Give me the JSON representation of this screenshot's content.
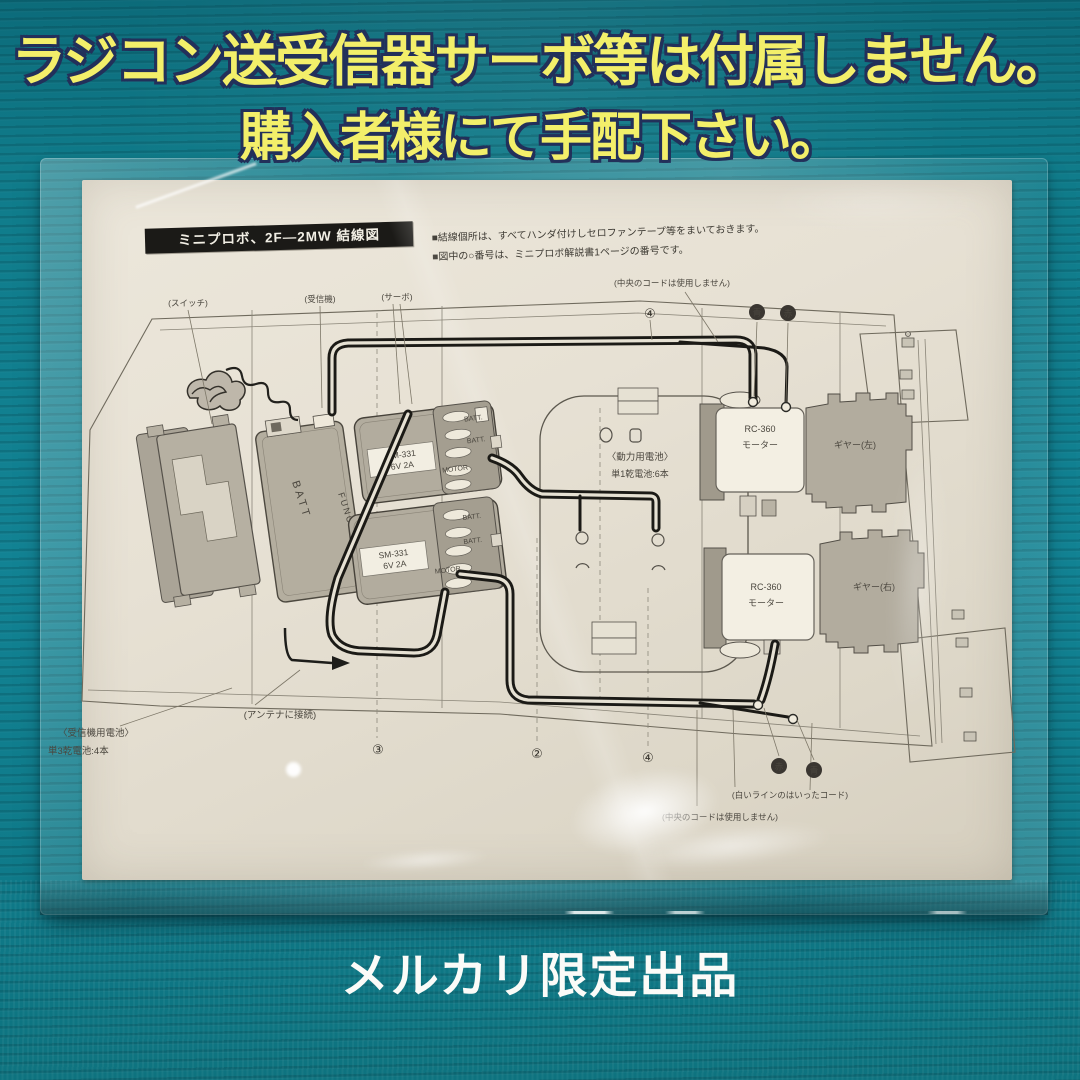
{
  "headline": {
    "line1": "ラジコン送受信器サーボ等は付属しません。",
    "line2": "購入者様にて手配下さい。",
    "text_color": "#f3ef6a",
    "outline_color": "#22305a"
  },
  "caption": {
    "text": "メルカリ限定出品",
    "color": "#fbfbf8"
  },
  "background": {
    "mat_color": "#128394"
  },
  "paper": {
    "title": "ミニプロボ、2F—2MW 結線図",
    "notes": {
      "line1": "■結線個所は、すべてハンダ付けしセロファンテープ等をまいておきます。",
      "line2": "■図中の○番号は、ミニプロボ解説書1ページの番号です。"
    }
  },
  "diagram": {
    "top_labels": {
      "switch": "(スイッチ)",
      "receiver": "(受信機)",
      "servo": "(サーボ)",
      "center_cord": "(中央のコードは使用しません)",
      "num4": "④",
      "dot_blue": "青",
      "dot_red": "赤"
    },
    "center": {
      "battery_line1": "〈動力用電池〉",
      "battery_line2": "単1乾電池:6本"
    },
    "receiver_unit": {
      "batt": "BATT",
      "func": "FUNC 2"
    },
    "servo_top": {
      "model": "SM-331",
      "spec": "6V  2A",
      "port1": "BATT.",
      "port2": "BATT.",
      "port3": "MOTOR"
    },
    "servo_bottom": {
      "model": "SM-331",
      "spec": "6V  2A",
      "port1": "BATT.",
      "port2": "BATT.",
      "port3": "MOTOR"
    },
    "motor_top": {
      "name": "RC-360",
      "type": "モーター",
      "gear": "ギヤー(左)"
    },
    "motor_bottom": {
      "name": "RC-360",
      "type": "モーター",
      "gear": "ギヤー(右)"
    },
    "bottom_labels": {
      "rx_battery1": "〈受信機用電池〉",
      "rx_battery2": "単3乾電池:4本",
      "antenna": "(アンテナに接続)",
      "num3": "③",
      "num2": "②",
      "num4": "④",
      "dot_red": "赤",
      "dot_blue": "青",
      "white_line": "(白いラインのはいったコード)",
      "center_cord": "(中央のコードは使用しません)"
    }
  }
}
